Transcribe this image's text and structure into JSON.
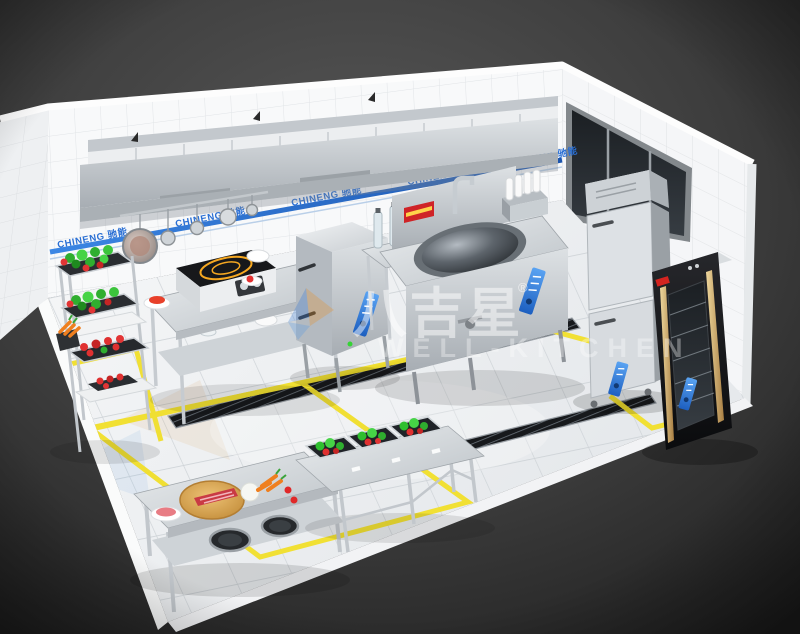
{
  "scene": {
    "description": "3D isometric render of a commercial stainless-steel kitchen with tiled walls, marble tile floor, yellow floor zone markings and floor drain channels"
  },
  "watermark": {
    "brand_cjk": "八吉星",
    "registered_mark": "®",
    "brand_latin": "WELL-KITCHEN"
  },
  "wall_branding": {
    "label": "CHINENG 驰能",
    "brand_latin": "CHINENG",
    "brand_cjk": "驰能"
  },
  "colors": {
    "background_dark": "#3c3c3c",
    "wall_tile_white": "#f8f9fa",
    "floor_marble": "#eff1f3",
    "floor_marking_yellow": "#f1df2d",
    "brand_blue": "#2a6fd4",
    "stainless_steel": "#c9ced3",
    "drain_black": "#17191c",
    "cabinet_black": "#121316",
    "cabinet_gold_trim": "#d8b87a",
    "vegetable_green": "#2fae2f",
    "vegetable_red": "#e03030",
    "wok_label_red": "#cf2327",
    "cutting_board_wood": "#d9a44e"
  }
}
